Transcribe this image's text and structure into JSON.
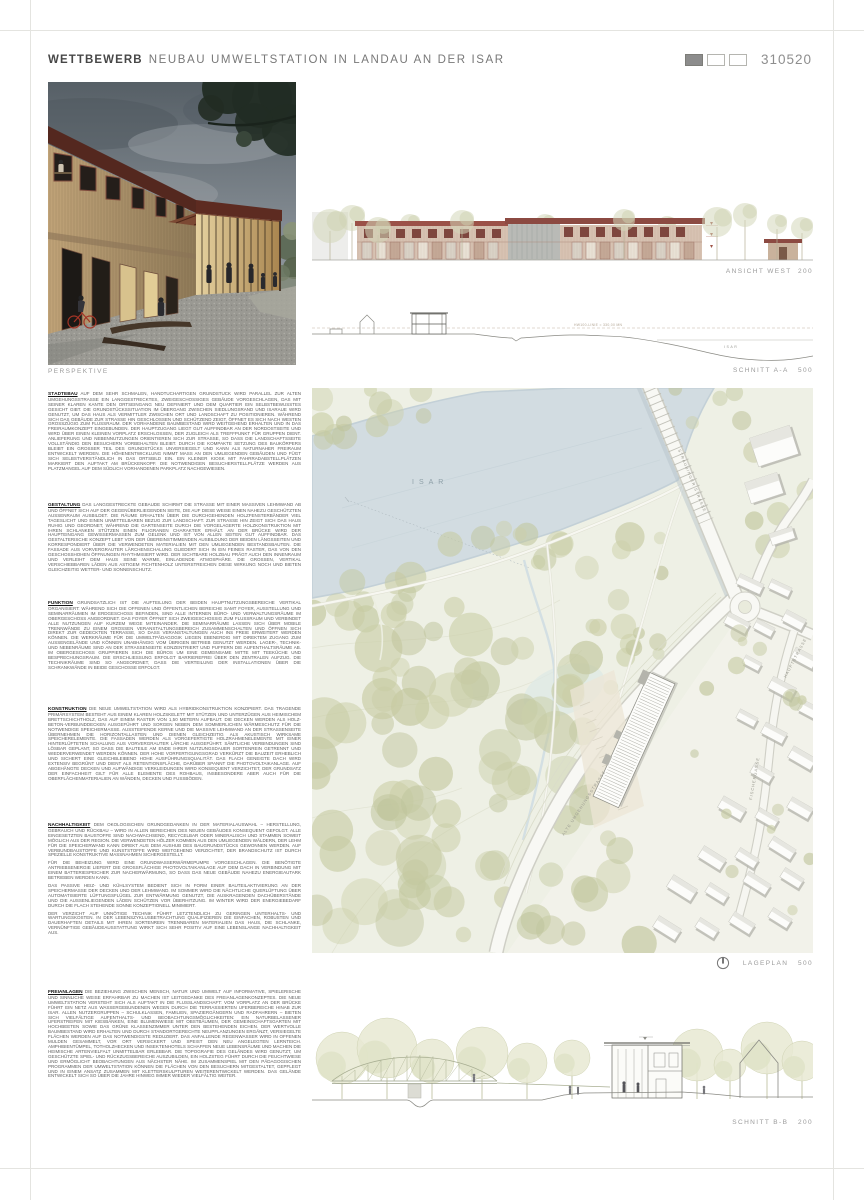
{
  "header": {
    "title_bold": "WETTBEWERB",
    "title_rest": "NEUBAU UMWELTSTATION IN LANDAU AN DER ISAR",
    "code": "310520",
    "swatches": [
      "#8c8c8c",
      "#ffffff",
      "#ffffff"
    ]
  },
  "captions": {
    "perspective": "PERSPEKTIVE",
    "elevation": "ANSICHT WEST  200",
    "section_a": "SCHNITT A-A   500",
    "siteplan": "LAGEPLAN   500",
    "section_b": "SCHNITT B-B   200"
  },
  "siteplan": {
    "river": "ISAR",
    "streets": {
      "straubinger": "STRAUBINGER STRASSE",
      "umgehung": "ALTE UMGEHUNGSSTRASSE",
      "fischergasse": "FISCHERGASSE",
      "haupt": "HAUPTSTRASSE"
    }
  },
  "section_a": {
    "hw_label": "HW100-LINIE = 330,00 MN",
    "river": "ISAR"
  },
  "colors": {
    "roof_red": "#8c4a42",
    "tree_green": "#c7cba3",
    "river_blue": "#d2dce1",
    "swatch_filled": "#8c8c8c"
  },
  "texts": [
    {
      "heading": "STÄDTEBAU",
      "body": "AUF DEM SEHR SCHMALEN, HANDTUCHARTIGEN GRUNDSTÜCK WIRD PARALLEL ZUR ALTEN UMGEHUNGSSTRASSE EIN LANGGESTRECKTES, ZWEIGESCHOSSIGES GEBÄUDE VORGESCHLAGEN, DAS MIT SEINER KLAREN KANTE DEN ORTSEINGANG NEU DEFINIERT UND DEM QUARTIER EIN SELBSTBEWUSSTES GESICHT GIBT. DIE GRUNDSTÜCKSSITUATION IM ÜBERGANG ZWISCHEN SIEDLUNGSRAND UND ISARAUE WIRD GENUTZT, UM DAS HAUS ALS VERMITTLER ZWISCHEN ORT UND LANDSCHAFT ZU POSITIONIEREN. WÄHREND SICH DAS GEBÄUDE ZUR STRASSE HIN GESCHLOSSEN UND SCHÜTZEND ZEIGT, ÖFFNET ES SICH NACH WESTEN GROSSZÜGIG ZUM FLUSSRAUM. DER VORHANDENE BAUMBESTAND WIRD WEITGEHEND ERHALTEN UND IN DAS FREIRAUMKONZEPT EINGEBUNDEN. DER HAUPTZUGANG LIEGT GUT AUFFINDBAR AN DER NORDOSTSEITE UND WIRD ÜBER EINEN KLEINEN VORPLATZ ERSCHLOSSEN, DER ZUGLEICH ALS TREFFPUNKT FÜR GRUPPEN DIENT. ANLIEFERUNG UND NEBENNUTZUNGEN ORIENTIEREN SICH ZUR STRASSE, SO DASS DIE LANDSCHAFTSSEITE VOLLSTÄNDIG DEN BESUCHERN VORBEHALTEN BLEIBT. DURCH DIE KOMPAKTE SETZUNG DES BAUKÖRPERS BLEIBT EIN GROSSER TEIL DES GRUNDSTÜCKS UNVERSIEGELT UND KANN ALS NATURNAHER FREIRAUM ENTWICKELT WERDEN. DIE HÖHENENTWICKLUNG NIMMT MASS AN DEN UMLIEGENDEN GEBÄUDEN UND FÜGT SICH SELBSTVERSTÄNDLICH IN DAS ORTSBILD EIN. EIN KLEINER KIOSK MIT FAHRRADABSTELLPLÄTZEN MARKIERT DEN AUFTAKT AM BRÜCKENKOPF. DIE NOTWENDIGEN BESUCHERSTELLPLÄTZE WERDEN AUS PLATZMANGEL AUF DEM SÜDLICH VORHANDENEN PARKPLATZ NACHGEWIESEN."
    },
    {
      "heading": "GESTALTUNG",
      "body": "DAS LANGGESTRECKTE GEBÄUDE SCHIRMT DIE STRASSE MIT EINER MASSIVEN LEHMWAND AB UND ÖFFNET SICH AUF DER GEGENÜBERLIEGENDEN SEITE, DIE AUF DIESE WEISE EINEN NAHEZU GESCHÜTZTEN AUSSENRAUM AUSBILDET. DIE RÄUME ERHALTEN ÜBER DIE DURCHGEHENDEN HOLZFENSTERBÄNDER VIEL TAGESLICHT UND EINEN UNMITTELBAREN BEZUG ZUR LANDSCHAFT. ZUR STRASSE HIN ZEIGT SICH DAS HAUS RUHIG UND GEORDNET, WÄHREND DIE GARTENSEITE DURCH DIE VORGELAGERTE HOLZKONSTRUKTION MIT IHREN SCHLANKEN STÜTZEN EINEN FILIGRANEN CHARAKTER ERHÄLT. AN DER BRÜCKE WIRD DER HAUPTEINGANG GEWISSERMASSEN ZUM GELENK UND IST VON ALLEN SEITEN GUT AUFFINDBAR. DAS GESTALTERISCHE KONZEPT LEBT VON DER ÜBEREINSTIMMENDEN AUSBILDUNG DER BEIDEN LÄNGSSEITEN UND KORRESPONDIERT ÜBER DIE VERWENDETEN MATERIALIEN MIT DEN UMLIEGENDEN BESTANDSBAUTEN. DIE FASSADE AUS VORVERGRAUTER LÄRCHENSCHALUNG GLIEDERT SICH IN EIN FEINES RASTER, DAS VON DEN GESCHOSSHOHEN ÖFFNUNGEN RHYTHMISIERT WIRD. DER SICHTBARE HOLZBAU PRÄGT AUCH DEN INNENRAUM UND VERLEIHT DEM HAUS SEINE WARME, EINLADENDE ATMOSPHÄRE. DIE GROSSEN, VERTIKAL VERSCHIEBBAREN LÄDEN AUS ASTIGEM FICHTENHOLZ UNTERSTREICHEN DIESE WIRKUNG NOCH UND BIETEN GLEICHZEITIG WETTER- UND SONNENSCHUTZ."
    },
    {
      "heading": "FUNKTION",
      "body": "GRUNDSÄTZLICH IST DIE AUFTEILUNG DER BEIDEN HAUPTNUTZUNGSBEREICHE VERTIKAL ORGANISIERT: WÄHREND SICH DIE OFFENEN UND ÖFFENTLICHEN BEREICHE SAMT FOYER, AUSSTELLUNG UND SEMINARRÄUMEN IM ERDGESCHOSS BEFINDEN, SIND ALLE INTERNEN BÜRO- UND VERWALTUNGSRÄUME IM OBERGESCHOSS ANGEORDNET. DAS FOYER ÖFFNET SICH ZWEIGESCHOSSIG ZUM FLUSSRAUM UND VERBINDET ALLE NUTZUNGEN AUF KURZEM WEGE MITEINANDER. DIE SEMINARRÄUME LASSEN SICH ÜBER MOBILE TRENNWÄNDE ZU EINEM GROSSEN VERANSTALTUNGSBEREICH ZUSAMMENSCHALTEN UND ÖFFNEN SICH DIREKT ZUR GEDECKTEN TERRASSE, SO DASS VERANSTALTUNGEN AUCH INS FREIE ERWEITERT WERDEN KÖNNEN. DIE WERKRÄUME FÜR DIE UMWELTPÄDAGOGIK LIEGEN EBENERDIG MIT DIREKTEM ZUGANG ZUM AUSSENGELÄNDE UND KÖNNEN UNABHÄNGIG VOM ÜBRIGEN BETRIEB GENUTZT WERDEN. LAGER-, TECHNIK- UND NEBENRÄUME SIND AN DER STRASSENSEITE KONZENTRIERT UND PUFFERN DIE AUFENTHALTSRÄUME AB. IM OBERGESCHOSS GRUPPIEREN SICH DIE BÜROS UM EINE GEMEINSAME MITTE MIT TEEKÜCHE UND BESPRECHUNGSRAUM. DIE ERSCHLIESSUNG ERFOLGT BARRIEREFREI ÜBER DEN ZENTRALEN AUFZUG. DIE TECHNIKRÄUME SIND SO ANGEORDNET, DASS DIE VERTEILUNG DER INSTALLATIONEN ÜBER DIE SCHRANKWÄNDE IN BEIDE GESCHOSSE ERFOLGT."
    },
    {
      "heading": "KONSTRUKTION",
      "body": "DIE NEUE UMWELTSTATION WIRD ALS HYBRIDKONSTRUKTION KONZIPIERT. DAS TRAGENDE PRIMÄRSYSTEM BESTEHT AUS EINEM KLAREN HOLZSKELETT MIT STÜTZEN UND UNTERZÜGEN AUS HEIMISCHEM BRETTSCHICHTHOLZ, DAS AUF EINEM RASTER VON 1,50 METERN AUFBAUT. DIE DECKEN WERDEN ALS HOLZ-BETON-VERBUNDDECKEN AUSGEFÜHRT UND SORGEN NEBEN DEM SOMMERLICHEN WÄRMESCHUTZ FÜR DIE NOTWENDIGE SPEICHERMASSE. AUSSTEIFENDE KERNE UND DIE MASSIVE LEHMWAND AN DER STRASSENSEITE ÜBERNEHMEN DIE HORIZONTALLASTEN UND DIENEN GLEICHZEITIG ALS AKUSTISCH WIRKSAME SPEICHERELEMENTE. DIE FASSADEN WERDEN ALS VORGEFERTIGTE HOLZRAHMENELEMENTE MIT EINER HINTERLÜFTETEN SCHALUNG AUS VORVERGRAUTER LÄRCHE AUSGEFÜHRT. SÄMTLICHE VERBINDUNGEN SIND LÖSBAR GEPLANT, SO DASS DIE BAUTEILE AM ENDE IHRER NUTZUNGSDAUER SORTENREIN GETRENNT UND WIEDERVERWENDET WERDEN KÖNNEN. DER HOHE VORFERTIGUNGSGRAD VERKÜRZT DIE BAUZEIT ERHEBLICH UND SICHERT EINE GLEICHBLEIBEND HOHE AUSFÜHRUNGSQUALITÄT. DAS FLACH GENEIGTE DACH WIRD EXTENSIV BEGRÜNT UND DIENT ALS RETENTIONSFLÄCHE, DARÜBER SPANNT DIE PHOTOVOLTAIKANLAGE. AUF ABGEHÄNGTE DECKEN UND AUFWÄNDIGE VERKLEIDUNGEN WIRD KONSEQUENT VERZICHTET, DER GRUNDSATZ DER EINFACHHEIT GILT FÜR ALLE ELEMENTE DES ROHBAUS, INSBESONDERE ABER AUCH FÜR DIE OBERFLÄCHENMATERIALIEN AN WÄNDEN, DECKEN UND FUSSBÖDEN."
    },
    {
      "heading": "NACHHALTIGKEIT",
      "body": "DEM ÖKOLOGISCHEN GRUNDGEDANKEN IN DER MATERIALAUSWAHL – HERSTELLUNG, GEBRAUCH UND RÜCKBAU – WIRD IN ALLEN BEREICHEN DES NEUEN GEBÄUDES KONSEQUENT GEFOLGT. ALLE EINGESETZTEN BAUSTOFFE SIND NACHWACHSEND, RECYCELBAR ODER MINERALISCH UND STAMMEN SOWEIT MÖGLICH AUS DER REGION. DIE VERWENDETEN HÖLZER KOMMEN AUS DEN UMLIEGENDEN WÄLDERN, DER LEHM FÜR DIE SPEICHERWAND KANN DIREKT AUS DEM AUSHUB DES BAUGRUNDSTÜCKS GEWONNEN WERDEN. AUF VERBUNDBAUSTOFFE UND KUNSTSTOFFE WIRD WEITGEHEND VERZICHTET, DER BRANDSCHUTZ IST DURCH SPEZIELLE KONSTRUKTIVE MASSNAHMEN SICHERGESTELLT.",
      "body2": "FÜR DIE BEHEIZUNG WIRD EINE GRUNDWASSERWÄRMEPUMPE VORGESCHLAGEN. DIE BENÖTIGTE ANTRIEBSENERGIE LIEFERT DIE GROSSFLÄCHIGE PHOTOVOLTAIKANLAGE AUF DEM DACH IN VERBINDUNG MIT EINEM BATTERIESPEICHER ZUR NACHERWÄRMUNG, SO DASS DAS NEUE GEBÄUDE NAHEZU ENERGIEAUTARK BETRIEBEN WERDEN KANN.",
      "body3": "DAS PASSIVE HEIZ- UND KÜHLSYSTEM BEDIENT SICH IN FORM EINER BAUTEILAKTIVIERUNG AN DER SPEICHERMASSE DER DECKEN UND DER LEHMWAND. IM SOMMER WIRD DIE NÄCHTLICHE QUERLÜFTUNG ÜBER AUTOMATISIERTE LÜFTUNGSFLÜGEL ZUR ENTWÄRMUNG GENUTZT, DIE AUSKRAGENDEN DACHÜBERSTÄNDE UND DIE AUSSENLIEGENDEN LÄDEN SCHÜTZEN VOR ÜBERHITZUNG. IM WINTER WIRD DER ENERGIEBEDARF DURCH DIE FLACH STEHENDE SONNE KONZEPTIONELL MINIMIERT.",
      "body4": "DER VERZICHT AUF UNNÖTIGE TECHNIK FÜHRT LETZTENDLICH ZU GERINGEN UNTERHALTS- UND WARTUNGSKOSTEN. IN DER LEBENSZYKLUSBETRACHTUNG QUALIFIZIEREN DIE EINFACHEN, ROBUSTEN UND DAUERHAFTEN DETAILS MIT IHREN SORTENREIN TRENNBAREN MATERIALIEN DAS HAUS, DIE SCHLANKE, VERNÜNFTIGE GEBÄUDEAUSSTATTUNG WIRKT SICH SEHR POSITIV AUF EINE LEBENSLANGE NACHHALTIGKEIT AUS."
    },
    {
      "heading": "FREIANLAGEN",
      "body": "DIE BEZIEHUNG ZWISCHEN MENSCH, NATUR UND UMWELT AUF INFORMATIVE, SPIELERISCHE UND SINNLICHE WEISE ERFAHRBAR ZU MACHEN IST LEITGEDANKE DES FREIANLAGENKONZEPTES. DIE NEUE UMWELTSTATION VERSTEHT SICH ALS AUFTAKT IN DIE FLUSSLANDSCHAFT: VOM VORPLATZ AN DER BRÜCKE FÜHRT EIN NETZ AUS WASSERGEBUNDENEN WEGEN DURCH DIE TERRASSIERTEN UFERBEREICHE HINAB ZUR ISAR. ALLEN NUTZERGRUPPEN – SCHULKLASSEN, FAMILIEN, SPAZIERGÄNGERN UND RADFAHRERN – BIETEN SICH VIELFÄLTIGE AUFENTHALTS- UND BEOBACHTUNGSMÖGLICHKEITEN: EIN NATURBELASSENER UFERSTREIFEN MIT KIESBÄNKEN, EINE BLUMENWIESE MIT OBSTBÄUMEN, DER GEMEINSCHAFTSGARTEN MIT HOCHBEETEN SOWIE DAS GRÜNE KLASSENZIMMER UNTER DEN BESTEHENDEN EICHEN. DER WERTVOLLE BAUMBESTAND WIRD ERHALTEN UND DURCH STANDORTGERECHTE NEUPFLANZUNGEN ERGÄNZT, VERSIEGELTE FLÄCHEN WERDEN AUF DAS NOTWENDIGSTE REDUZIERT. DAS ANFALLENDE REGENWASSER WIRD IN OFFENEN MULDEN GESAMMELT, VOR ORT VERSICKERT UND SPEIST DEN NEU ANGELEGTEN LERNTEICH. AMPHIBIENTÜMPEL, TOTHOLZHECKEN UND INSEKTENHOTELS SCHAFFEN NEUE LEBENSRÄUME UND MACHEN DIE HEIMISCHE ARTENVIELFALT UNMITTELBAR ERLEBBAR. DIE TOPOGRAFIE DES GELÄNDES WIRD GENUTZT, UM GESCHÜTZTE SPIEL- UND RÜCKZUGSBEREICHE AUSZUBILDEN, EIN HOLZSTEG FÜHRT DURCH DIE FEUCHTWIESE UND ERMÖGLICHT BEOBACHTUNGEN AUS NÄCHSTER NÄHE. IM ZUSAMMENSPIEL MIT DEN PÄDAGOGISCHEN PROGRAMMEN DER UMWELTSTATION KÖNNEN DIE FLÄCHEN VON DEN BESUCHERN MITGESTALTET, GEPFLEGT UND IN EINEM ANSATZ ZUSAMMEN MIT KLETTERSKULPTUREN WEITERENTWICKELT WERDEN. DAS GELÄNDE ENTWICKELT SICH SO ÜBER DIE JAHRE HINWEG IMMER WIEDER VIELFÄLTIG WEITER."
    }
  ]
}
